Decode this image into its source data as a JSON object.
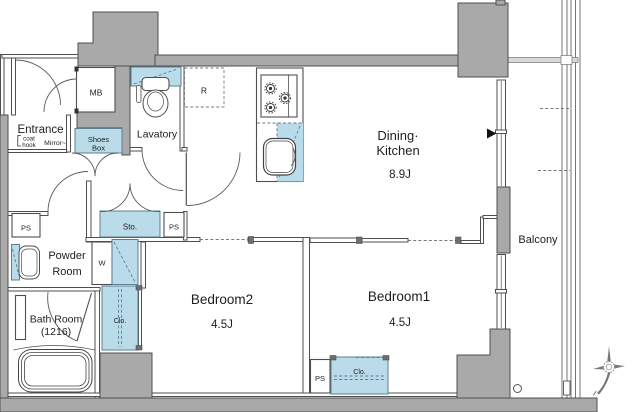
{
  "rooms": {
    "dining_kitchen": {
      "line1": "Dining·",
      "line2": "Kitchen",
      "size": "8.9J"
    },
    "bedroom1": {
      "label": "Bedroom1",
      "size": "4.5J"
    },
    "bedroom2": {
      "label": "Bedroom2",
      "size": "4.5J"
    },
    "lavatory": {
      "label": "Lavatory"
    },
    "powder_room": {
      "line1": "Powder",
      "line2": "Room"
    },
    "bath_room": {
      "line1": "Bath Room",
      "line2": "(1216)"
    },
    "entrance": {
      "label": "Entrance",
      "coat_line1": "coat",
      "coat_line2": "hook",
      "mirror": "Mirror~"
    },
    "balcony": {
      "label": "Balcony"
    }
  },
  "fixtures": {
    "meter_box": "MB",
    "shoes_box_line1": "Shoes",
    "shoes_box_line2": "Box",
    "refrigerator": "R",
    "storage": "Sto.",
    "pipe_space": "PS",
    "washer": "W",
    "closet": "Clo."
  },
  "colors": {
    "wall_fill": "#a9a9a9",
    "wall_stroke": "#4f4f4f",
    "fixture_blue": "#badbe9",
    "fixture_blue_stroke": "#5e7f90",
    "text": "#1e1e1e"
  }
}
